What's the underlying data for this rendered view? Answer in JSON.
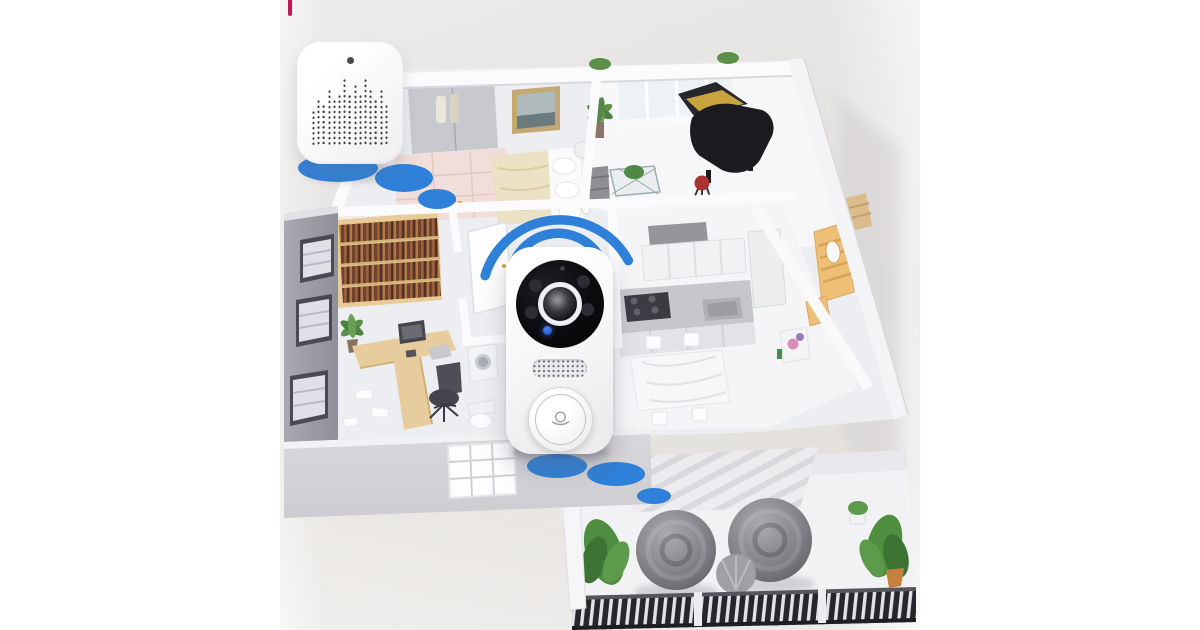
{
  "meta": {
    "description": "Product illustration: smart wireless video doorbell and indoor chime shown over an isometric apartment floor plan with Wi-Fi signal graphics",
    "background_color": "#ffffff",
    "crop_mark_color": "#c2185b"
  },
  "signal": {
    "color": "#2f80d8",
    "arc_count": 2,
    "floor_spots": [
      {
        "cx": 338,
        "cy": 168,
        "rx": 40,
        "ry": 14
      },
      {
        "cx": 404,
        "cy": 178,
        "rx": 29,
        "ry": 14
      },
      {
        "cx": 437,
        "cy": 199,
        "rx": 19,
        "ry": 10
      },
      {
        "cx": 557,
        "cy": 466,
        "rx": 30,
        "ry": 12
      },
      {
        "cx": 616,
        "cy": 474,
        "rx": 29,
        "ry": 12
      },
      {
        "cx": 654,
        "cy": 496,
        "rx": 17,
        "ry": 8
      }
    ]
  },
  "devices": {
    "chime": {
      "name": "wireless-chime-receiver",
      "body_color": "#ffffff",
      "led_color": "#4a4a50",
      "speaker_dot_color": "#3c3c40",
      "speaker_columns": [
        7,
        9,
        8,
        11,
        9,
        10,
        13,
        10,
        12,
        10,
        13,
        11,
        9,
        11,
        8
      ]
    },
    "doorbell": {
      "name": "smart-video-doorbell",
      "body_color": "#ffffff",
      "camera_bezel_color": "#0b0b0e",
      "lens_ring_color": "#edeff2",
      "ir_led_color": "#2c2c33",
      "status_led_color": "#2a5cd8",
      "button_icon": "doorbell-ring-icon"
    }
  },
  "floorplan": {
    "rooms": [
      "bedroom",
      "music-room",
      "study",
      "home-office",
      "kitchen",
      "dining-area",
      "bathroom",
      "hallway",
      "balcony"
    ]
  }
}
